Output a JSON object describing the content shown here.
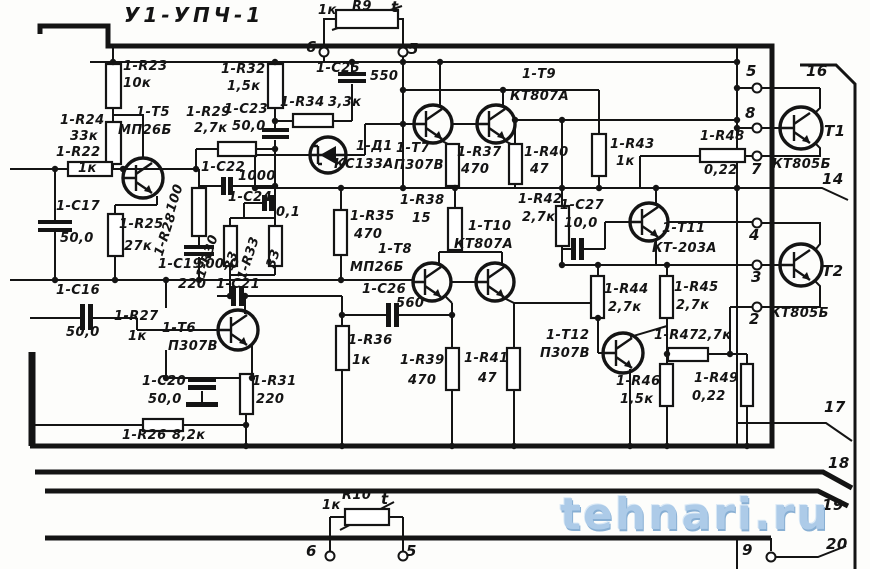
{
  "title": "У1-УПЧ-1",
  "watermark": "tehnari.ru",
  "colors": {
    "ink": "#141414",
    "paper": "#fdfdfb",
    "watermark_blue": "#a7c7e7"
  },
  "labels": [
    {
      "t": "1к",
      "x": 318,
      "y": 4
    },
    {
      "t": "R9",
      "x": 352,
      "y": 0
    },
    {
      "t": "t",
      "x": 391,
      "y": 0,
      "cls": "pin"
    },
    {
      "t": "6",
      "x": 306,
      "y": 40,
      "cls": "pin"
    },
    {
      "t": "5",
      "x": 408,
      "y": 42,
      "cls": "pin"
    },
    {
      "t": "1-R23",
      "x": 123,
      "y": 60
    },
    {
      "t": "10к",
      "x": 123,
      "y": 77
    },
    {
      "t": "1-R32",
      "x": 221,
      "y": 63
    },
    {
      "t": "1,5к",
      "x": 227,
      "y": 80
    },
    {
      "t": "1-С25",
      "x": 316,
      "y": 62
    },
    {
      "t": "550",
      "x": 370,
      "y": 70
    },
    {
      "t": "1-R34",
      "x": 280,
      "y": 96
    },
    {
      "t": "3,3к",
      "x": 328,
      "y": 96
    },
    {
      "t": "1-Т9",
      "x": 522,
      "y": 68
    },
    {
      "t": "КТ807А",
      "x": 510,
      "y": 90
    },
    {
      "t": "1-R24",
      "x": 60,
      "y": 114
    },
    {
      "t": "33к",
      "x": 70,
      "y": 130
    },
    {
      "t": "1-R22",
      "x": 56,
      "y": 146
    },
    {
      "t": "1к",
      "x": 78,
      "y": 162
    },
    {
      "t": "1-Т5",
      "x": 136,
      "y": 106
    },
    {
      "t": "МП26Б",
      "x": 118,
      "y": 124
    },
    {
      "t": "1-R29",
      "x": 186,
      "y": 106
    },
    {
      "t": "2,7к",
      "x": 194,
      "y": 122
    },
    {
      "t": "1-С23",
      "x": 224,
      "y": 103
    },
    {
      "t": "50,0",
      "x": 232,
      "y": 120
    },
    {
      "t": "1-Д1",
      "x": 356,
      "y": 140
    },
    {
      "t": "КС133А",
      "x": 334,
      "y": 158
    },
    {
      "t": "1-Т7",
      "x": 396,
      "y": 142
    },
    {
      "t": "П307В",
      "x": 394,
      "y": 159
    },
    {
      "t": "1-R37",
      "x": 457,
      "y": 146
    },
    {
      "t": "470",
      "x": 461,
      "y": 163
    },
    {
      "t": "1-R40",
      "x": 524,
      "y": 146
    },
    {
      "t": "47",
      "x": 530,
      "y": 163
    },
    {
      "t": "1-R43",
      "x": 610,
      "y": 138
    },
    {
      "t": "1к",
      "x": 616,
      "y": 155
    },
    {
      "t": "1-R48",
      "x": 700,
      "y": 130
    },
    {
      "t": "0,22",
      "x": 704,
      "y": 164
    },
    {
      "t": "5",
      "x": 746,
      "y": 64,
      "cls": "pin"
    },
    {
      "t": "8",
      "x": 745,
      "y": 106,
      "cls": "pin"
    },
    {
      "t": "7",
      "x": 751,
      "y": 162,
      "cls": "pin"
    },
    {
      "t": "16",
      "x": 806,
      "y": 64,
      "cls": "pin"
    },
    {
      "t": "Т1",
      "x": 824,
      "y": 124,
      "cls": "pin"
    },
    {
      "t": "КТ805Б",
      "x": 772,
      "y": 158
    },
    {
      "t": "14",
      "x": 822,
      "y": 172,
      "cls": "pin"
    },
    {
      "t": "1-С17",
      "x": 56,
      "y": 200
    },
    {
      "t": "50,0",
      "x": 60,
      "y": 232
    },
    {
      "t": "1-R25",
      "x": 119,
      "y": 218
    },
    {
      "t": "27к",
      "x": 124,
      "y": 240
    },
    {
      "t": "100",
      "x": 178,
      "y": 200,
      "cls": "rot"
    },
    {
      "t": "1-R28",
      "x": 166,
      "y": 244,
      "cls": "rot"
    },
    {
      "t": "1-R30",
      "x": 208,
      "y": 266,
      "cls": "rot"
    },
    {
      "t": "33",
      "x": 236,
      "y": 258,
      "cls": "rot"
    },
    {
      "t": "1-R33",
      "x": 249,
      "y": 268,
      "cls": "rot"
    },
    {
      "t": "33",
      "x": 278,
      "y": 256,
      "cls": "rot"
    },
    {
      "t": "1-С22",
      "x": 201,
      "y": 161
    },
    {
      "t": "1000",
      "x": 238,
      "y": 170
    },
    {
      "t": "1-С24",
      "x": 228,
      "y": 191
    },
    {
      "t": "0,1",
      "x": 276,
      "y": 206
    },
    {
      "t": "1-С19",
      "x": 158,
      "y": 258
    },
    {
      "t": "500,0",
      "x": 196,
      "y": 258
    },
    {
      "t": "220",
      "x": 178,
      "y": 278
    },
    {
      "t": "1-С21",
      "x": 216,
      "y": 278
    },
    {
      "t": "1-R35",
      "x": 350,
      "y": 210
    },
    {
      "t": "470",
      "x": 354,
      "y": 228
    },
    {
      "t": "1-R38",
      "x": 400,
      "y": 194
    },
    {
      "t": "15",
      "x": 412,
      "y": 212
    },
    {
      "t": "1-Т10",
      "x": 468,
      "y": 220
    },
    {
      "t": "КТ807А",
      "x": 454,
      "y": 238
    },
    {
      "t": "1-R42",
      "x": 518,
      "y": 193
    },
    {
      "t": "2,7к",
      "x": 522,
      "y": 211
    },
    {
      "t": "1-С27",
      "x": 560,
      "y": 199
    },
    {
      "t": "10,0",
      "x": 564,
      "y": 217
    },
    {
      "t": "1-Т11",
      "x": 662,
      "y": 222
    },
    {
      "t": "КТ-203А",
      "x": 652,
      "y": 242
    },
    {
      "t": "1-С16",
      "x": 56,
      "y": 284
    },
    {
      "t": "50,0",
      "x": 66,
      "y": 326
    },
    {
      "t": "1-R27",
      "x": 114,
      "y": 310
    },
    {
      "t": "1к",
      "x": 128,
      "y": 330
    },
    {
      "t": "1-Т6",
      "x": 162,
      "y": 322
    },
    {
      "t": "П307В",
      "x": 168,
      "y": 340
    },
    {
      "t": "1-Т8",
      "x": 378,
      "y": 243
    },
    {
      "t": "МП26Б",
      "x": 350,
      "y": 261
    },
    {
      "t": "1-С26",
      "x": 362,
      "y": 283
    },
    {
      "t": "560",
      "x": 396,
      "y": 297
    },
    {
      "t": "1-R36",
      "x": 348,
      "y": 334
    },
    {
      "t": "1к",
      "x": 352,
      "y": 354
    },
    {
      "t": "1-R39",
      "x": 400,
      "y": 354
    },
    {
      "t": "470",
      "x": 408,
      "y": 374
    },
    {
      "t": "1-R41",
      "x": 464,
      "y": 352
    },
    {
      "t": "47",
      "x": 478,
      "y": 372
    },
    {
      "t": "1-Т12",
      "x": 546,
      "y": 329
    },
    {
      "t": "П307В",
      "x": 540,
      "y": 347
    },
    {
      "t": "1-R44",
      "x": 604,
      "y": 283
    },
    {
      "t": "2,7к",
      "x": 608,
      "y": 301
    },
    {
      "t": "1-R45",
      "x": 674,
      "y": 281
    },
    {
      "t": "2,7к",
      "x": 676,
      "y": 299
    },
    {
      "t": "1-R47",
      "x": 654,
      "y": 329
    },
    {
      "t": "2,7к",
      "x": 698,
      "y": 329
    },
    {
      "t": "1-R46",
      "x": 616,
      "y": 375
    },
    {
      "t": "1,5к",
      "x": 620,
      "y": 393
    },
    {
      "t": "1-R49",
      "x": 694,
      "y": 372
    },
    {
      "t": "0,22",
      "x": 692,
      "y": 390
    },
    {
      "t": "4",
      "x": 749,
      "y": 228,
      "cls": "pin"
    },
    {
      "t": "3",
      "x": 751,
      "y": 270,
      "cls": "pin"
    },
    {
      "t": "2",
      "x": 749,
      "y": 312,
      "cls": "pin"
    },
    {
      "t": "Т2",
      "x": 822,
      "y": 264,
      "cls": "pin"
    },
    {
      "t": "КТ805Б",
      "x": 770,
      "y": 307
    },
    {
      "t": "17",
      "x": 824,
      "y": 400,
      "cls": "pin"
    },
    {
      "t": "18",
      "x": 828,
      "y": 456,
      "cls": "pin"
    },
    {
      "t": "19",
      "x": 822,
      "y": 498,
      "cls": "pin"
    },
    {
      "t": "20",
      "x": 826,
      "y": 537,
      "cls": "pin"
    },
    {
      "t": "1-С20",
      "x": 142,
      "y": 375
    },
    {
      "t": "50,0",
      "x": 148,
      "y": 393
    },
    {
      "t": "1-R31",
      "x": 252,
      "y": 375
    },
    {
      "t": "220",
      "x": 256,
      "y": 393
    },
    {
      "t": "1-R26",
      "x": 122,
      "y": 429
    },
    {
      "t": "8,2к",
      "x": 172,
      "y": 429
    },
    {
      "t": "1к",
      "x": 322,
      "y": 499
    },
    {
      "t": "R10",
      "x": 342,
      "y": 489
    },
    {
      "t": "t",
      "x": 381,
      "y": 492,
      "cls": "pin"
    },
    {
      "t": "6",
      "x": 306,
      "y": 544,
      "cls": "pin"
    },
    {
      "t": "5",
      "x": 406,
      "y": 544,
      "cls": "pin"
    },
    {
      "t": "9",
      "x": 742,
      "y": 543,
      "cls": "pin"
    }
  ],
  "schematic": {
    "resistors": [
      {
        "n": "resistor-r23",
        "x": 106,
        "y": 64,
        "w": 15,
        "h": 44
      },
      {
        "n": "resistor-r24",
        "x": 106,
        "y": 122,
        "w": 15,
        "h": 42
      },
      {
        "n": "resistor-r22",
        "x": 68,
        "y": 162,
        "w": 44,
        "h": 14
      },
      {
        "n": "resistor-r32",
        "x": 268,
        "y": 64,
        "w": 15,
        "h": 44
      },
      {
        "n": "resistor-r25",
        "x": 108,
        "y": 214,
        "w": 15,
        "h": 42
      },
      {
        "n": "resistor-r29",
        "x": 218,
        "y": 142,
        "w": 38,
        "h": 14
      },
      {
        "n": "resistor-r28",
        "x": 192,
        "y": 188,
        "w": 14,
        "h": 48
      },
      {
        "n": "resistor-r30",
        "x": 224,
        "y": 226,
        "w": 13,
        "h": 40
      },
      {
        "n": "resistor-r33",
        "x": 269,
        "y": 226,
        "w": 13,
        "h": 40
      },
      {
        "n": "resistor-r34",
        "x": 293,
        "y": 114,
        "w": 40,
        "h": 13
      },
      {
        "n": "resistor-r35",
        "x": 334,
        "y": 210,
        "w": 13,
        "h": 45
      },
      {
        "n": "resistor-r36",
        "x": 336,
        "y": 326,
        "w": 13,
        "h": 44
      },
      {
        "n": "resistor-r37",
        "x": 446,
        "y": 144,
        "w": 13,
        "h": 42
      },
      {
        "n": "resistor-r38",
        "x": 448,
        "y": 208,
        "w": 14,
        "h": 42
      },
      {
        "n": "resistor-r39",
        "x": 446,
        "y": 348,
        "w": 13,
        "h": 42
      },
      {
        "n": "resistor-r40",
        "x": 509,
        "y": 144,
        "w": 13,
        "h": 40
      },
      {
        "n": "resistor-r41",
        "x": 507,
        "y": 348,
        "w": 13,
        "h": 42
      },
      {
        "n": "resistor-r42",
        "x": 556,
        "y": 206,
        "w": 13,
        "h": 40
      },
      {
        "n": "resistor-r43",
        "x": 592,
        "y": 134,
        "w": 14,
        "h": 42
      },
      {
        "n": "resistor-r44",
        "x": 591,
        "y": 276,
        "w": 13,
        "h": 42
      },
      {
        "n": "resistor-r45",
        "x": 660,
        "y": 276,
        "w": 13,
        "h": 42
      },
      {
        "n": "resistor-r46",
        "x": 660,
        "y": 364,
        "w": 13,
        "h": 42
      },
      {
        "n": "resistor-r47",
        "x": 668,
        "y": 348,
        "w": 40,
        "h": 13
      },
      {
        "n": "resistor-r48",
        "x": 700,
        "y": 149,
        "w": 45,
        "h": 13
      },
      {
        "n": "resistor-r49",
        "x": 741,
        "y": 364,
        "w": 12,
        "h": 42
      },
      {
        "n": "resistor-r31",
        "x": 240,
        "y": 374,
        "w": 13,
        "h": 40
      },
      {
        "n": "resistor-r26",
        "x": 143,
        "y": 419,
        "w": 40,
        "h": 12
      },
      {
        "n": "thermistor-r9",
        "x": 336,
        "y": 10,
        "w": 62,
        "h": 18
      },
      {
        "n": "thermistor-r10",
        "x": 345,
        "y": 509,
        "w": 44,
        "h": 16
      }
    ],
    "cap_plates": [
      {
        "n": "capacitor-c17",
        "x": 38,
        "y": 220,
        "w": 34,
        "h": 4
      },
      {
        "n": "capacitor-c17",
        "x": 38,
        "y": 228,
        "w": 34,
        "h": 4
      },
      {
        "n": "capacitor-c16",
        "x": 80,
        "y": 304,
        "w": 5,
        "h": 26
      },
      {
        "n": "capacitor-c16",
        "x": 88,
        "y": 304,
        "w": 5,
        "h": 26
      },
      {
        "n": "capacitor-c19",
        "x": 184,
        "y": 245,
        "w": 30,
        "h": 4
      },
      {
        "n": "capacitor-c19",
        "x": 184,
        "y": 252,
        "w": 30,
        "h": 4
      },
      {
        "n": "capacitor-c20",
        "x": 188,
        "y": 378,
        "w": 28,
        "h": 4
      },
      {
        "n": "capacitor-c20",
        "x": 188,
        "y": 385,
        "w": 28,
        "h": 5
      },
      {
        "n": "capacitor-c20-ground",
        "x": 186,
        "y": 402,
        "w": 32,
        "h": 5
      },
      {
        "n": "capacitor-c21",
        "x": 231,
        "y": 286,
        "w": 5,
        "h": 20
      },
      {
        "n": "capacitor-c21",
        "x": 239,
        "y": 286,
        "w": 5,
        "h": 20
      },
      {
        "n": "capacitor-c22",
        "x": 221,
        "y": 177,
        "w": 5,
        "h": 18
      },
      {
        "n": "capacitor-c22",
        "x": 228,
        "y": 177,
        "w": 5,
        "h": 18
      },
      {
        "n": "capacitor-c23",
        "x": 262,
        "y": 128,
        "w": 27,
        "h": 4
      },
      {
        "n": "capacitor-c23",
        "x": 262,
        "y": 135,
        "w": 27,
        "h": 4
      },
      {
        "n": "capacitor-c24",
        "x": 262,
        "y": 195,
        "w": 5,
        "h": 16
      },
      {
        "n": "capacitor-c24",
        "x": 269,
        "y": 195,
        "w": 5,
        "h": 16
      },
      {
        "n": "capacitor-c25",
        "x": 338,
        "y": 72,
        "w": 28,
        "h": 4
      },
      {
        "n": "capacitor-c25",
        "x": 338,
        "y": 79,
        "w": 28,
        "h": 4
      },
      {
        "n": "capacitor-c26",
        "x": 386,
        "y": 303,
        "w": 5,
        "h": 24
      },
      {
        "n": "capacitor-c26",
        "x": 394,
        "y": 303,
        "w": 5,
        "h": 24
      },
      {
        "n": "capacitor-c27",
        "x": 571,
        "y": 238,
        "w": 5,
        "h": 22
      },
      {
        "n": "capacitor-c27",
        "x": 579,
        "y": 238,
        "w": 5,
        "h": 22
      }
    ],
    "transistors": [
      {
        "n": "transistor-t5",
        "cx": 143,
        "cy": 178,
        "r": 20
      },
      {
        "n": "transistor-t6",
        "cx": 238,
        "cy": 330,
        "r": 20
      },
      {
        "n": "transistor-t7",
        "cx": 433,
        "cy": 124,
        "r": 19
      },
      {
        "n": "transistor-t9",
        "cx": 496,
        "cy": 124,
        "r": 19
      },
      {
        "n": "transistor-t8",
        "cx": 432,
        "cy": 282,
        "r": 19
      },
      {
        "n": "transistor-t10",
        "cx": 495,
        "cy": 282,
        "r": 19
      },
      {
        "n": "transistor-t11",
        "cx": 649,
        "cy": 222,
        "r": 19
      },
      {
        "n": "transistor-t12",
        "cx": 623,
        "cy": 353,
        "r": 20
      },
      {
        "n": "transistor-t1",
        "cx": 801,
        "cy": 128,
        "r": 21
      },
      {
        "n": "transistor-t2",
        "cx": 801,
        "cy": 265,
        "r": 21
      }
    ],
    "diode": {
      "n": "zener-diode-d1",
      "cx": 328,
      "cy": 155,
      "r": 18
    },
    "terminals": [
      {
        "n": "terminal-6-top",
        "x": 324,
        "y": 52
      },
      {
        "n": "terminal-5-top",
        "x": 403,
        "y": 52
      },
      {
        "n": "terminal-5",
        "x": 757,
        "y": 88
      },
      {
        "n": "terminal-8",
        "x": 757,
        "y": 128
      },
      {
        "n": "terminal-7",
        "x": 757,
        "y": 156
      },
      {
        "n": "terminal-4",
        "x": 757,
        "y": 223
      },
      {
        "n": "terminal-3",
        "x": 757,
        "y": 265
      },
      {
        "n": "terminal-2",
        "x": 757,
        "y": 307
      },
      {
        "n": "terminal-6-bottom",
        "x": 330,
        "y": 556
      },
      {
        "n": "terminal-5-bottom",
        "x": 403,
        "y": 556
      },
      {
        "n": "terminal-9",
        "x": 771,
        "y": 557
      }
    ],
    "junctions": [
      [
        113,
        62
      ],
      [
        275,
        62
      ],
      [
        352,
        62
      ],
      [
        403,
        62
      ],
      [
        440,
        62
      ],
      [
        737,
        62
      ],
      [
        55,
        169
      ],
      [
        123,
        169
      ],
      [
        196,
        169
      ],
      [
        275,
        121
      ],
      [
        275,
        149
      ],
      [
        275,
        186
      ],
      [
        403,
        90
      ],
      [
        503,
        90
      ],
      [
        403,
        124
      ],
      [
        255,
        188
      ],
      [
        341,
        188
      ],
      [
        403,
        188
      ],
      [
        455,
        188
      ],
      [
        562,
        188
      ],
      [
        599,
        188
      ],
      [
        656,
        188
      ],
      [
        737,
        188
      ],
      [
        515,
        120
      ],
      [
        562,
        120
      ],
      [
        737,
        120
      ],
      [
        55,
        280
      ],
      [
        115,
        280
      ],
      [
        166,
        280
      ],
      [
        199,
        280
      ],
      [
        341,
        280
      ],
      [
        230,
        296
      ],
      [
        245,
        296
      ],
      [
        342,
        315
      ],
      [
        452,
        315
      ],
      [
        166,
        378
      ],
      [
        252,
        378
      ],
      [
        246,
        425
      ],
      [
        562,
        265
      ],
      [
        598,
        265
      ],
      [
        667,
        265
      ],
      [
        667,
        354
      ],
      [
        730,
        354
      ],
      [
        598,
        318
      ],
      [
        246,
        446
      ],
      [
        342,
        446
      ],
      [
        452,
        446
      ],
      [
        514,
        446
      ],
      [
        630,
        446
      ],
      [
        667,
        446
      ],
      [
        747,
        446
      ],
      [
        737,
        88
      ],
      [
        737,
        128
      ]
    ]
  }
}
